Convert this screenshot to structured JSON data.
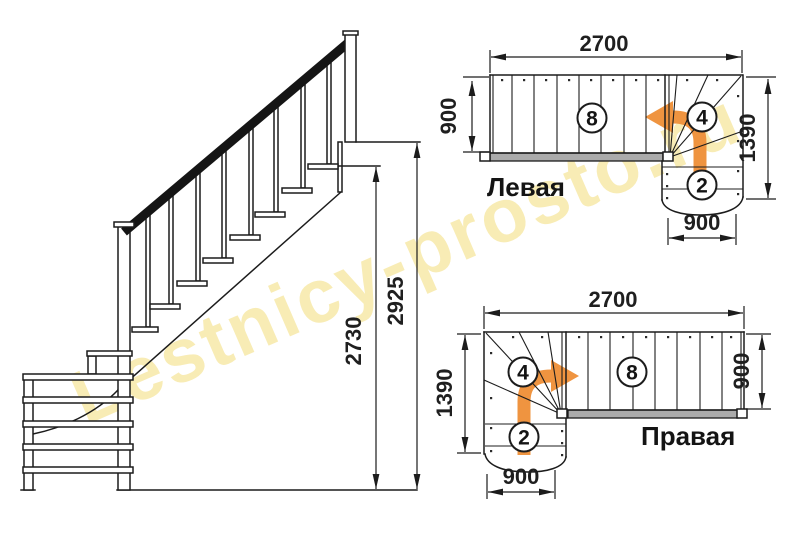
{
  "watermark": {
    "text": "Lestnicy-prosto.ru",
    "color": "#f0d864"
  },
  "colors": {
    "arrow": "#ef9440",
    "line": "#1c1c1c",
    "stringer_fill": "#ababab"
  },
  "elevation": {
    "dim_total_height": "2925",
    "dim_stair_height": "2730"
  },
  "plan_left": {
    "label": "Левая",
    "dim_total_width": "2700",
    "dim_flight_width": "900",
    "dim_turn_depth": "1390",
    "dim_turn_width": "900",
    "steps_straight": "8",
    "steps_winder": "4",
    "steps_bottom": "2"
  },
  "plan_right": {
    "label": "Правая",
    "dim_total_width": "2700",
    "dim_flight_width": "900",
    "dim_turn_depth": "1390",
    "dim_turn_width": "900",
    "steps_straight": "8",
    "steps_winder": "4",
    "steps_bottom": "2"
  }
}
